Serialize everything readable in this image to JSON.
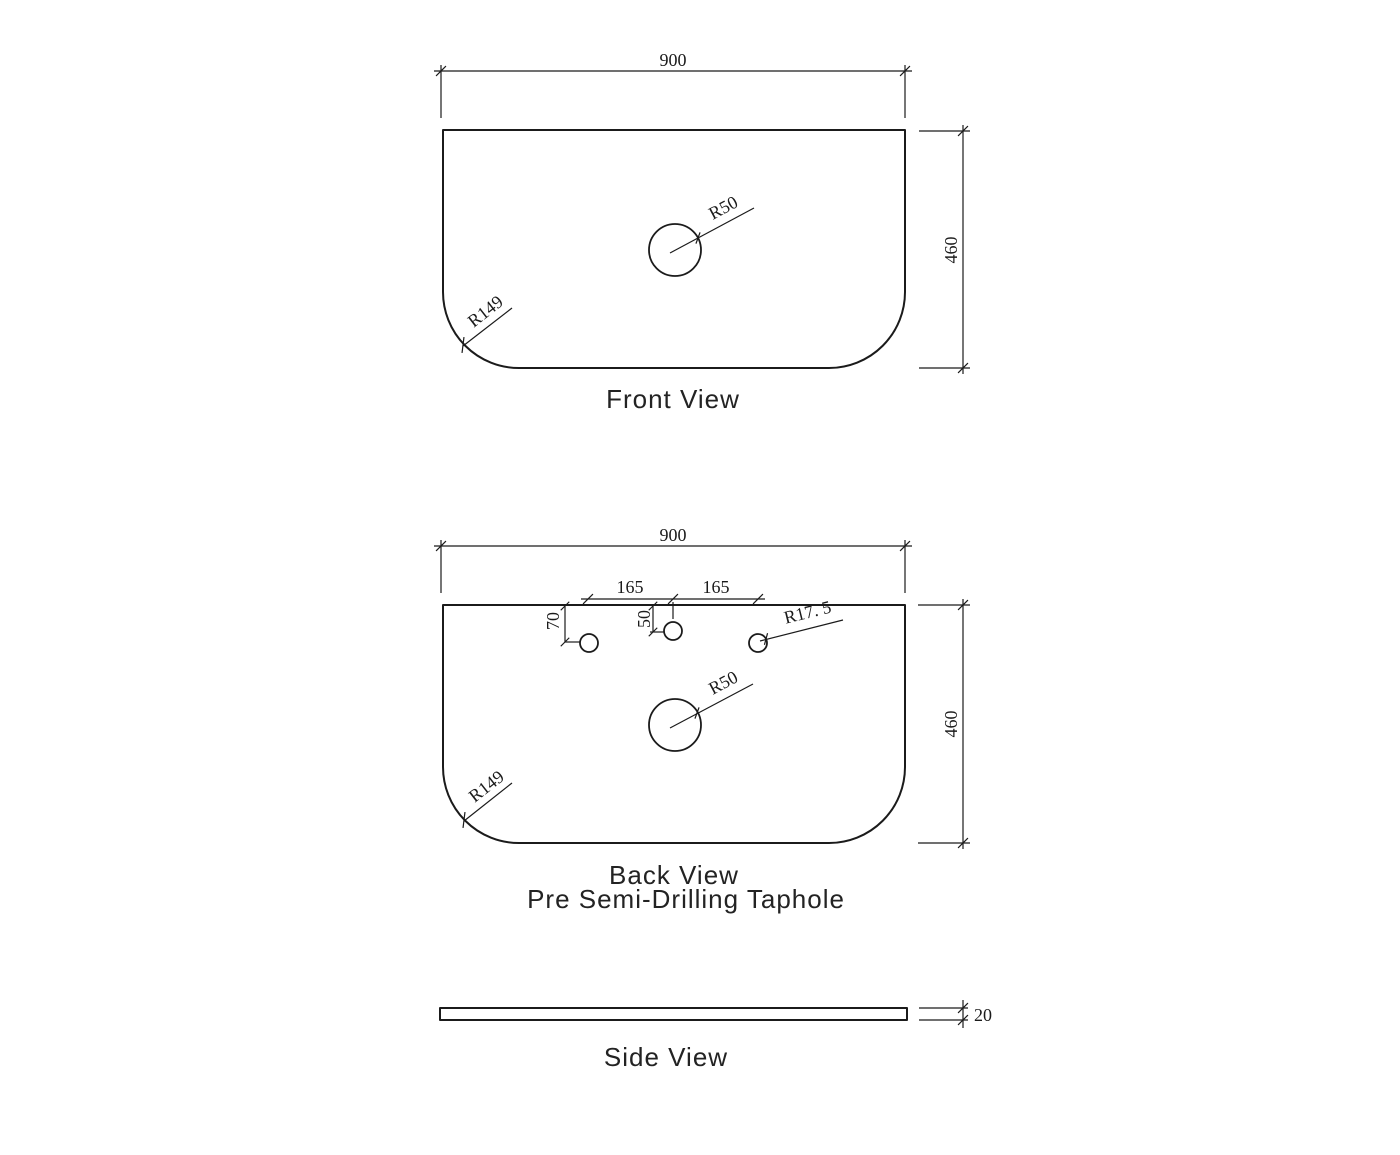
{
  "drawing": {
    "type": "technical-dimension-drawing",
    "colors": {
      "line": "#1b1b1b",
      "background": "#ffffff"
    },
    "views": {
      "front": {
        "label": "Front View",
        "width_dim": "900",
        "height_dim": "460",
        "hole_radius_label": "R50",
        "corner_radius_label": "R149"
      },
      "back": {
        "label": "Back View",
        "sublabel": "Pre Semi-Drilling Taphole",
        "width_dim": "900",
        "height_dim": "460",
        "tap_spacing_left": "165",
        "tap_spacing_right": "165",
        "outer_taphole_offset": "70",
        "center_taphole_offset": "50",
        "taphole_radius_label": "R17. 5",
        "hole_radius_label": "R50",
        "corner_radius_label": "R149"
      },
      "side": {
        "label": "Side View",
        "thickness_dim": "20"
      }
    }
  }
}
